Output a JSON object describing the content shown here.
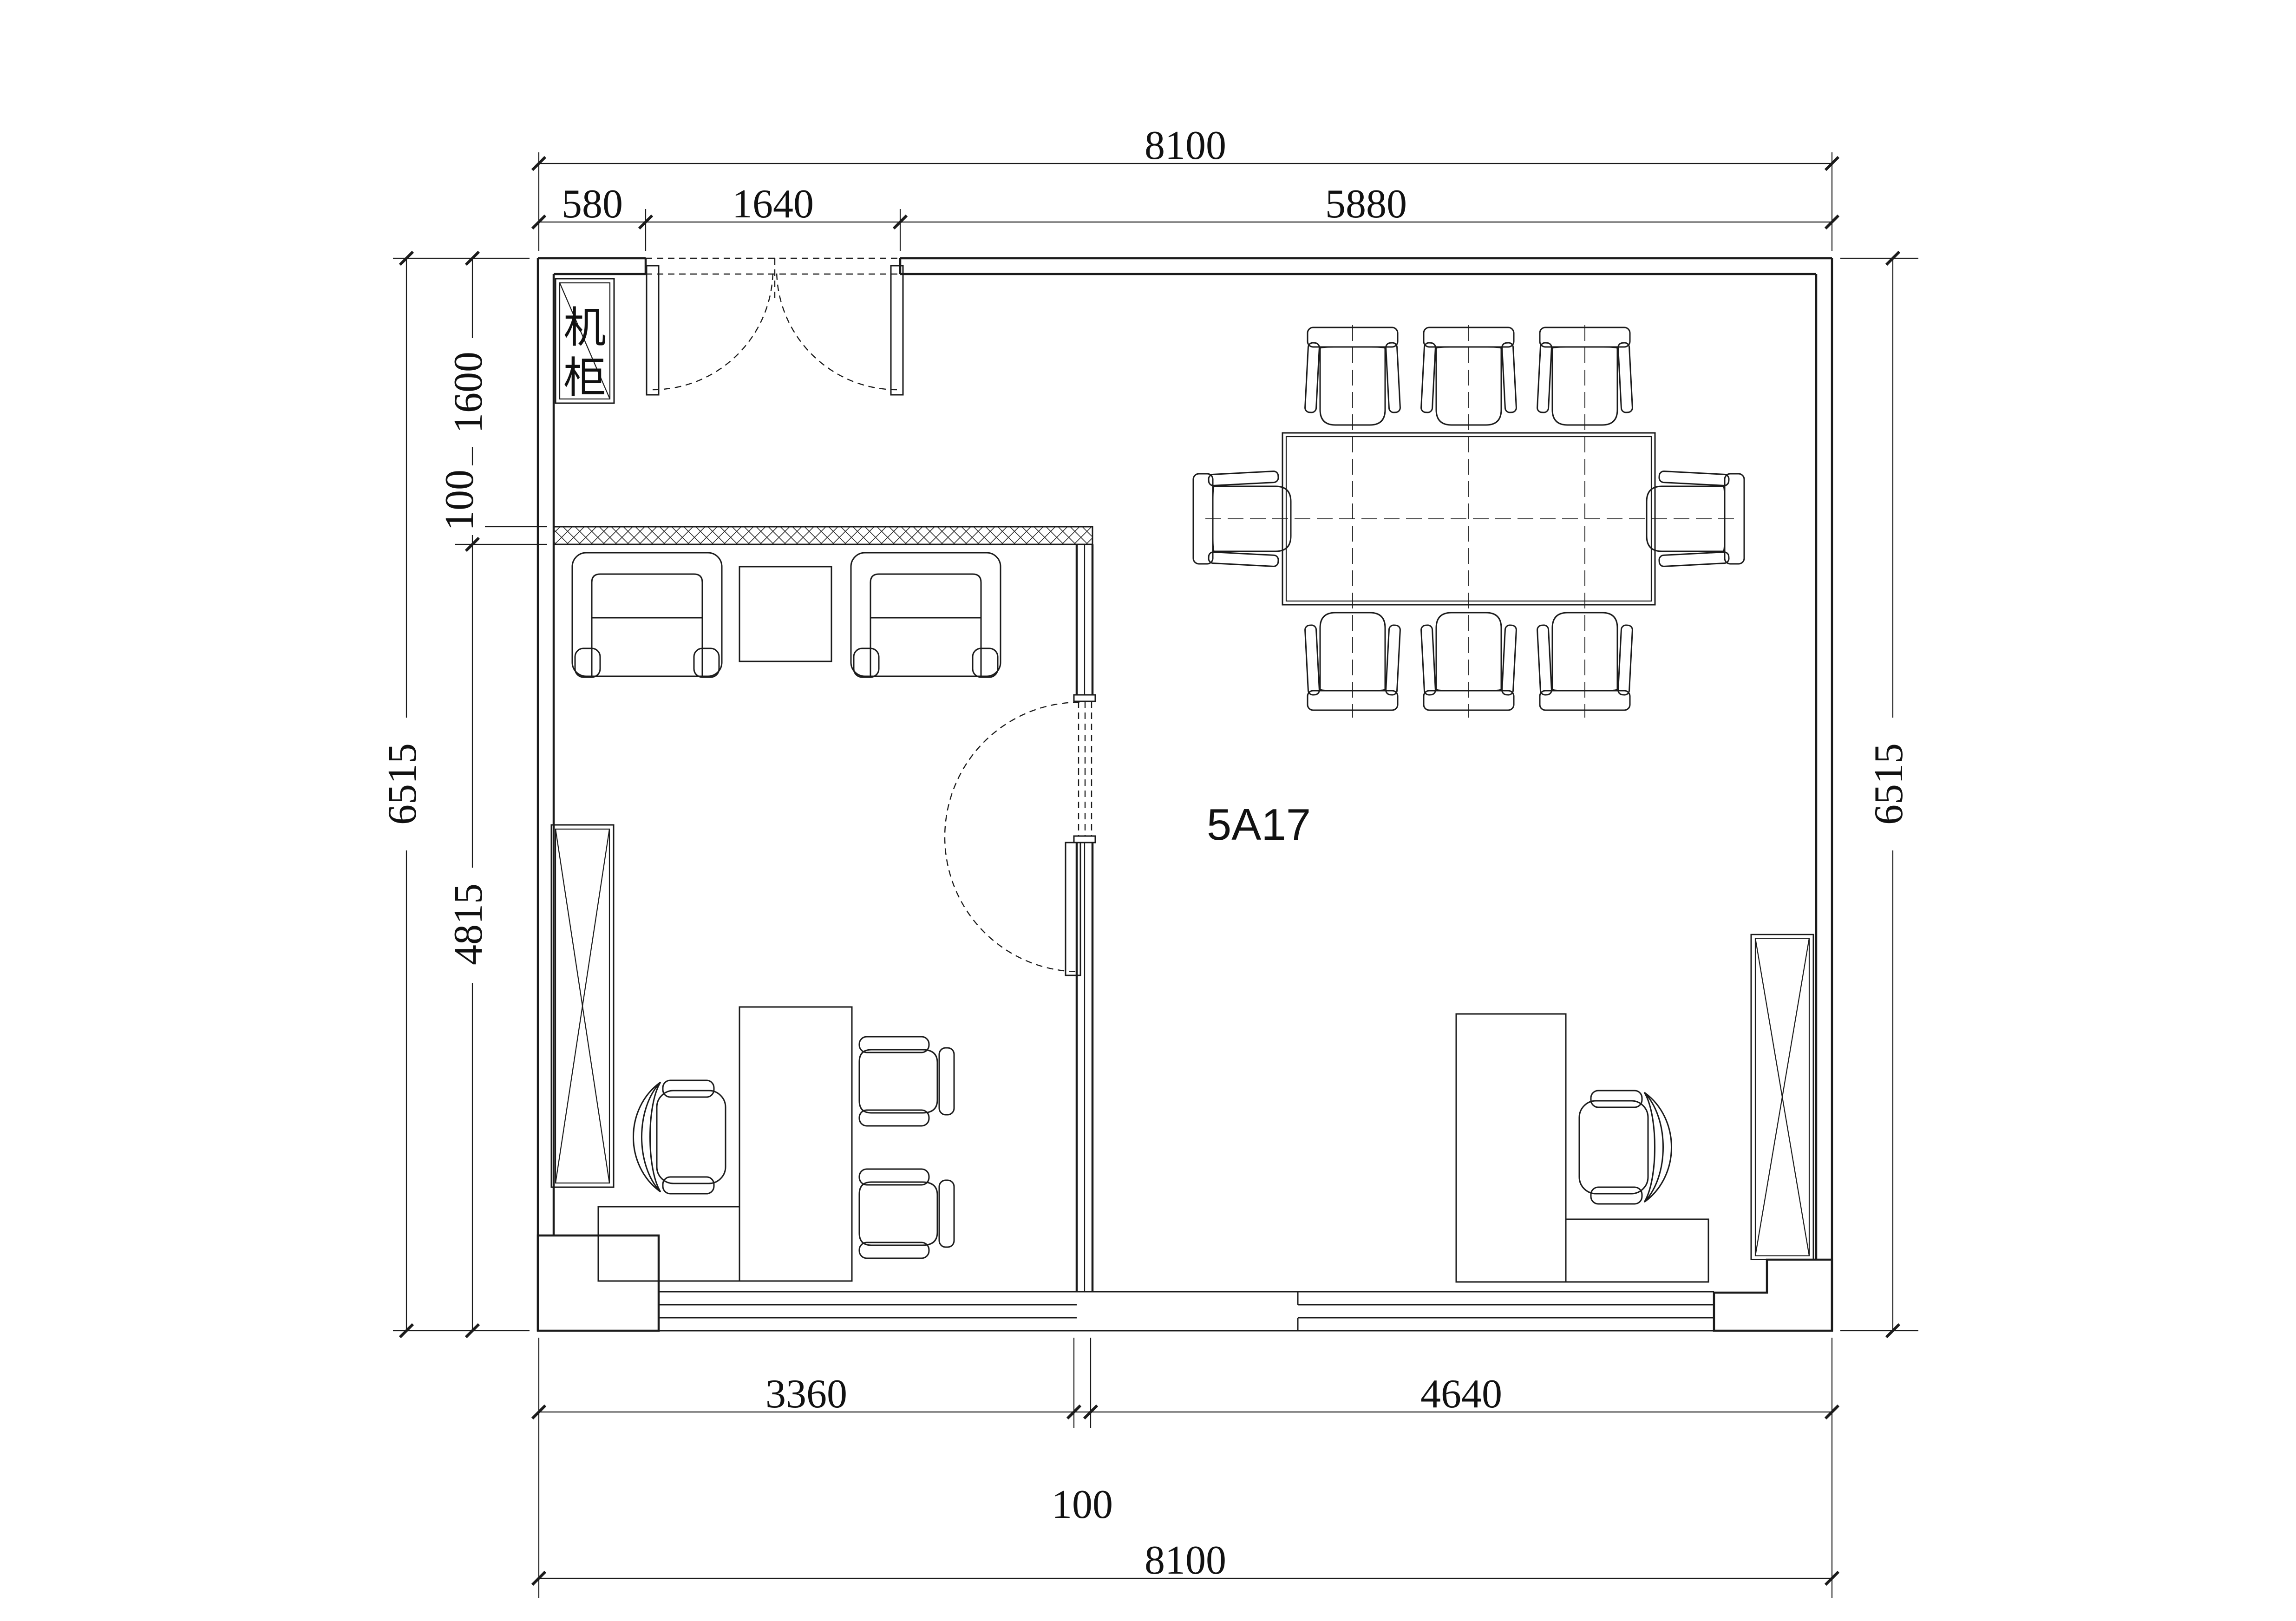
{
  "drawing": {
    "labels": {
      "room": "5A17",
      "cabinet": "机柜",
      "cabinet_chars": [
        "机",
        "柜"
      ]
    },
    "dims": {
      "top": {
        "overall": "8100",
        "segments": [
          "580",
          "1640",
          "5880"
        ]
      },
      "bottom": {
        "overall": "8100",
        "segments": [
          "3360",
          "100",
          "4640"
        ]
      },
      "left": {
        "overall": "6515",
        "segments": [
          "1600",
          "100",
          "4815"
        ]
      },
      "right": {
        "overall": "6515"
      }
    },
    "colors": {
      "ink": "#1b1b1b",
      "paper": "#ffffff"
    }
  }
}
